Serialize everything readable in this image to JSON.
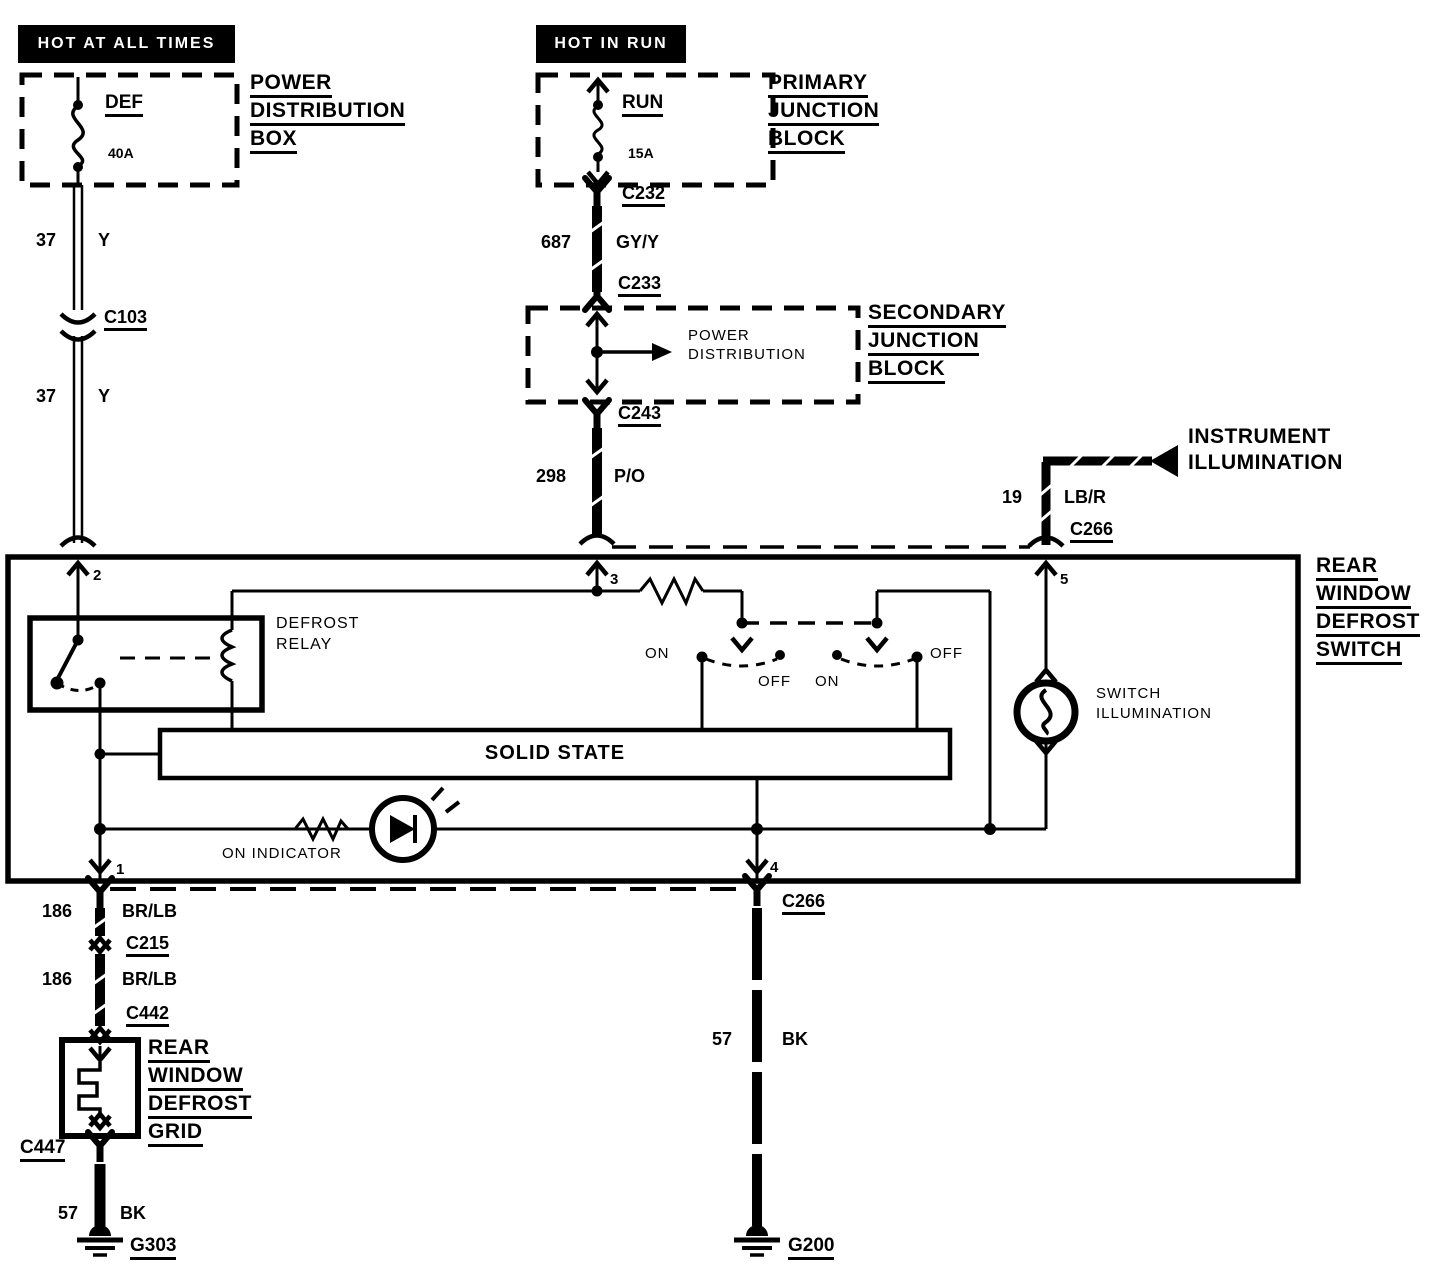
{
  "headers": {
    "left": "HOT AT ALL TIMES",
    "middle": "HOT IN RUN"
  },
  "power_distribution_box": {
    "fuse": "DEF",
    "rating": "40A",
    "label": [
      "POWER",
      "DISTRIBUTION",
      "BOX"
    ]
  },
  "primary_junction_block": {
    "fuse": "RUN",
    "rating": "15A",
    "label": [
      "PRIMARY",
      "JUNCTION",
      "BLOCK"
    ]
  },
  "secondary_junction_block": {
    "inner": [
      "POWER",
      "DISTRIBUTION"
    ],
    "label": [
      "SECONDARY",
      "JUNCTION",
      "BLOCK"
    ]
  },
  "instrument_illumination": {
    "label": [
      "INSTRUMENT",
      "ILLUMINATION"
    ]
  },
  "rear_window_defrost_switch": {
    "label": [
      "REAR",
      "WINDOW",
      "DEFROST",
      "SWITCH"
    ],
    "relay": [
      "DEFROST",
      "RELAY"
    ],
    "solid_state": "SOLID STATE",
    "on_indicator": "ON INDICATOR",
    "switch_illumination": [
      "SWITCH",
      "ILLUMINATION"
    ],
    "positions": {
      "left_on": "ON",
      "left_off": "OFF",
      "right_on": "ON",
      "right_off": "OFF"
    },
    "pins": {
      "p1": "1",
      "p2": "2",
      "p3": "3",
      "p4": "4",
      "p5": "5"
    }
  },
  "rear_window_defrost_grid": {
    "label": [
      "REAR",
      "WINDOW",
      "DEFROST",
      "GRID"
    ]
  },
  "connectors": {
    "c103": "C103",
    "c232": "C232",
    "c233": "C233",
    "c243": "C243",
    "c266_top": "C266",
    "c266_bottom": "C266",
    "c215": "C215",
    "c442": "C442",
    "c447": "C447"
  },
  "grounds": {
    "g303": "G303",
    "g200": "G200"
  },
  "wires": {
    "w37a": {
      "id": "37",
      "color": "Y"
    },
    "w37b": {
      "id": "37",
      "color": "Y"
    },
    "w687": {
      "id": "687",
      "color": "GY/Y"
    },
    "w298": {
      "id": "298",
      "color": "P/O"
    },
    "w19": {
      "id": "19",
      "color": "LB/R"
    },
    "w186a": {
      "id": "186",
      "color": "BR/LB"
    },
    "w186b": {
      "id": "186",
      "color": "BR/LB"
    },
    "w57a": {
      "id": "57",
      "color": "BK"
    },
    "w57b": {
      "id": "57",
      "color": "BK"
    }
  },
  "colors": {
    "ink": "#000000",
    "paper": "#ffffff"
  }
}
